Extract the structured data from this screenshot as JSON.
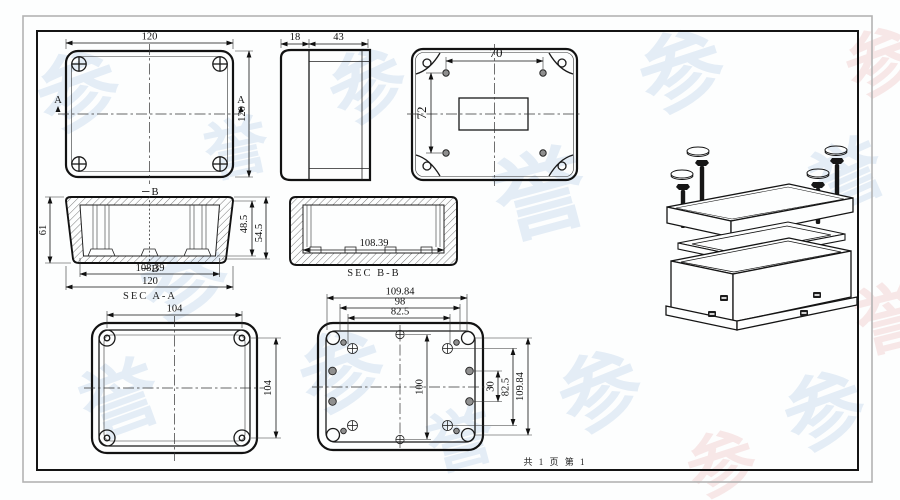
{
  "footer": {
    "page_info": "共 1 页  第 1"
  },
  "watermark": {
    "glyph": "参",
    "glyph2": "誉"
  },
  "views": {
    "top": {
      "dim_width": "120",
      "dim_height": "120",
      "section_a_left": "A",
      "section_a_right": "A"
    },
    "side": {
      "dim_lid_depth": "18",
      "dim_base_depth": "43"
    },
    "back": {
      "dim_holes_h": "70",
      "dim_holes_v": "72"
    },
    "sec_aa": {
      "label": "SEC A-A",
      "dim_total_height": "61",
      "dim_inner_depth": "48.5",
      "dim_step_depth": "54.5",
      "dim_inner_width": "108.39",
      "dim_outer_width": "120",
      "marker_top": "B",
      "marker_bottom": "B"
    },
    "sec_bb": {
      "label": "SEC B-B",
      "dim_inner_width": "108.39"
    },
    "lid": {
      "dim_width": "104",
      "dim_height": "104"
    },
    "base": {
      "dim_outer_width": "109.84",
      "dim_mount_width": "98",
      "dim_boss_width": "82.5",
      "dim_center_height": "100",
      "dim_rib_spacing": "30",
      "dim_boss_height": "82.5",
      "dim_outer_height": "109.84"
    }
  },
  "colors": {
    "line": "#111111",
    "watermark_blue": "#84acd8",
    "watermark_pink": "#e29494"
  }
}
